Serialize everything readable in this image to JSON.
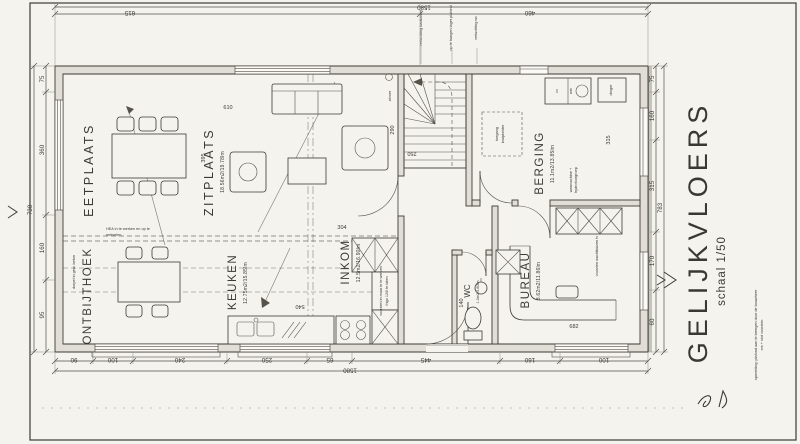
{
  "colors": {
    "paper": "#f4f3ee",
    "ink": "#3c3a34",
    "wall_fill": "#e0ded6",
    "faint_line": "#8f8d86"
  },
  "title_block": {
    "title": "GELIJKVLOERS",
    "scale": "schaal 1/50",
    "note1": "opmerking: plafond aan te brengen door de bouwheer",
    "note2": "rvs + slot voorzien"
  },
  "rooms": {
    "eetplaats": {
      "name": "EETPLAATS"
    },
    "zitplaats": {
      "name": "ZITPLAATS",
      "area": "18.56m2/19.78lm"
    },
    "ontbijthoek": {
      "name": "ONTBIJTHOEK"
    },
    "keuken": {
      "name": "KEUKEN",
      "area": "12.75m2/15.85lm"
    },
    "inkom": {
      "name": "INKOM",
      "area": "12.5m2/16.90lm"
    },
    "berging": {
      "name": "BERGING",
      "area": "11.1m2/13.85lm"
    },
    "bureau": {
      "name": "BUREAU",
      "area": "8.62m2/11.86lm"
    },
    "wc": {
      "name": "WC",
      "area": "1.3m2/4.60lm"
    }
  },
  "appliances": {
    "cv": "cv",
    "wm": "wm",
    "droger": "droger"
  },
  "annotations": {
    "hea1": "HEA in te werken en op te",
    "hea2": "metselen",
    "kruip1": "toegang",
    "kruip2": "kruipkelder",
    "vent1": "verluchting badkamer",
    "vent2": "op te hangen lager plafond",
    "vent3": "verluchting wc",
    "afvoer": "afvoer",
    "frigo1": "voorzien in muur in te werken",
    "frigo2": "frigo 120l te laten",
    "hydro1": "wasmachine +",
    "hydro2": "hydrofoorgroep",
    "wachtbuis": "voorzien wachtbuizen tv",
    "dorpel": "dorpel in gew. beton"
  },
  "dimensions": {
    "top": {
      "d1": "615",
      "d2": "460",
      "total": "1580"
    },
    "bottom": {
      "d1": "90",
      "d2": "100",
      "d3": "240",
      "d4": "250",
      "d5": "65",
      "d6": "445",
      "d7": "160",
      "d8": "100",
      "total": "1580"
    },
    "left": {
      "d1": "75",
      "d2": "360",
      "d3": "160",
      "d4": "95",
      "total": "730"
    },
    "right": {
      "d1": "75",
      "d2": "160",
      "d3": "315",
      "d4": "170",
      "d5": "60",
      "total": "783"
    },
    "interior": {
      "zit_w": "610",
      "zit_h": "395",
      "sofa": "304",
      "hal": "290",
      "stair": "250",
      "berging": "315",
      "bureau": "682",
      "wc": "140",
      "keuken": "540"
    }
  }
}
